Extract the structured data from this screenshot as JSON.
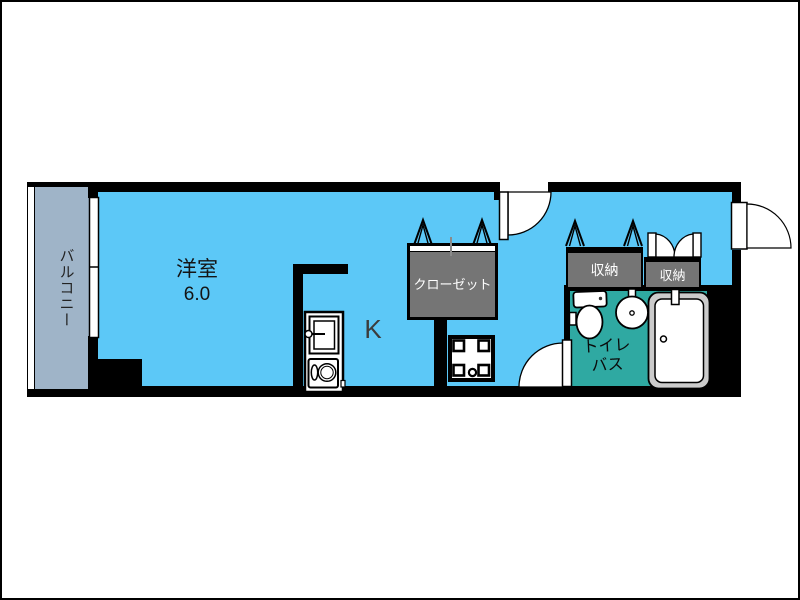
{
  "plan_type": "floor-plan",
  "colors": {
    "room": "#5CC8F7",
    "balcony": "#9FB4C8",
    "storage": "#757575",
    "bath": "#2FA9A2",
    "wall": "#000000",
    "tub_rim": "#CBCBCB",
    "label": "#1A1A1A"
  },
  "labels": {
    "balcony": "バルコニー",
    "room": "洋室",
    "room_size": "6.0",
    "kitchen": "K",
    "closet": "クローゼット",
    "storage_left": "収納",
    "storage_right": "収納",
    "toilet": "トイレ",
    "bath": "バス"
  }
}
